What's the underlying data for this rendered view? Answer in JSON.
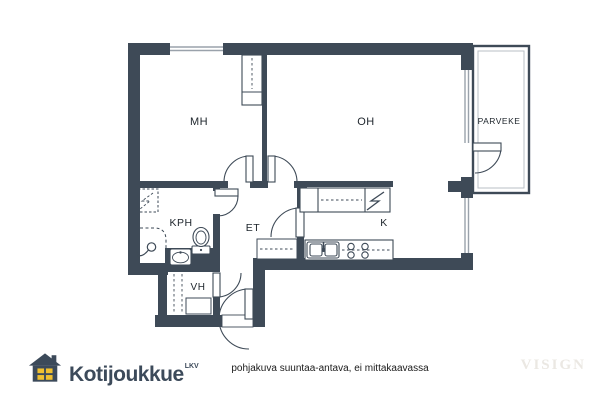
{
  "floorplan": {
    "rooms": {
      "mh": {
        "label": "MH"
      },
      "oh": {
        "label": "OH"
      },
      "parveke": {
        "label": "PARVEKE"
      },
      "kph": {
        "label": "KPH"
      },
      "et": {
        "label": "ET"
      },
      "k": {
        "label": "K"
      },
      "vh": {
        "label": "VH"
      }
    },
    "colors": {
      "wall": "#3e4a57",
      "floor": "#ffffff",
      "window_line": "#9aa2ab"
    },
    "fixtures": [
      "bedroom-wardrobe",
      "kitchen-upper-cabinets",
      "fridge",
      "kitchen-counter",
      "double-sink",
      "stove",
      "hallway-closet",
      "washing-machine-reservation",
      "shower",
      "toilet",
      "washbasin",
      "closet-cabinets",
      "balcony-railing"
    ]
  },
  "footer": {
    "brand": "Kotijoukkue",
    "brand_suffix": "LKV",
    "caption": "pohjakuva suuntaa-antava, ei mittakaavassa",
    "watermark": "VISIGN"
  },
  "colors": {
    "brand_slate": "#3c4a5a",
    "house_window_yellow": "#f0c030",
    "watermark_gray": "#ebe8e3",
    "caption_text": "#1a1a1a"
  }
}
